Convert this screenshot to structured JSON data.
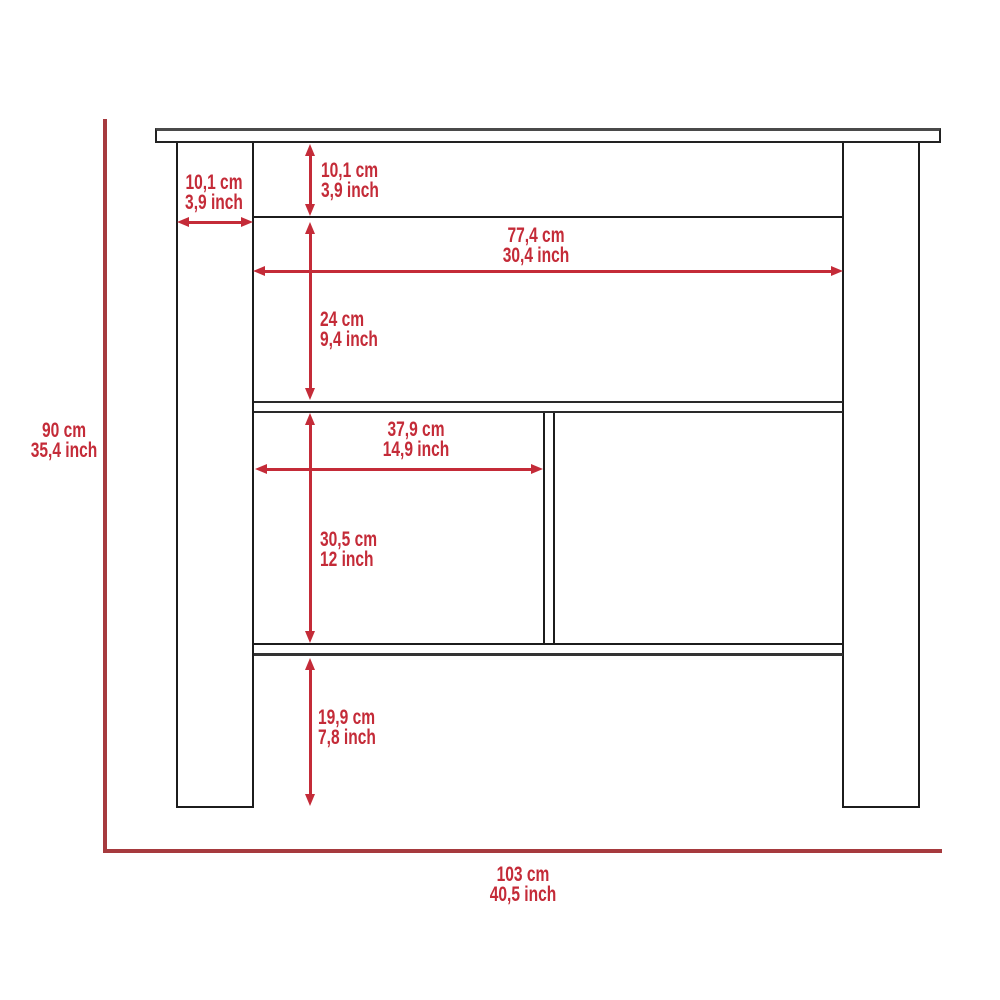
{
  "colors": {
    "dimension_red": "#c42b38",
    "overall_red": "#a63a3e",
    "line_dark": "#1c1c1c"
  },
  "dimensions": {
    "leg_width": {
      "metric": "10,1 cm",
      "imperial": "3,9 inch"
    },
    "top_panel_height": {
      "metric": "10,1 cm",
      "imperial": "3,9 inch"
    },
    "inner_width": {
      "metric": "77,4 cm",
      "imperial": "30,4 inch"
    },
    "upper_section_height": {
      "metric": "24 cm",
      "imperial": "9,4 inch"
    },
    "compartment_width": {
      "metric": "37,9 cm",
      "imperial": "14,9 inch"
    },
    "compartment_height": {
      "metric": "30,5 cm",
      "imperial": "12 inch"
    },
    "bottom_clearance": {
      "metric": "19,9 cm",
      "imperial": "7,8 inch"
    },
    "overall_height": {
      "metric": "90 cm",
      "imperial": "35,4 inch"
    },
    "overall_width": {
      "metric": "103 cm",
      "imperial": "40,5 inch"
    }
  }
}
